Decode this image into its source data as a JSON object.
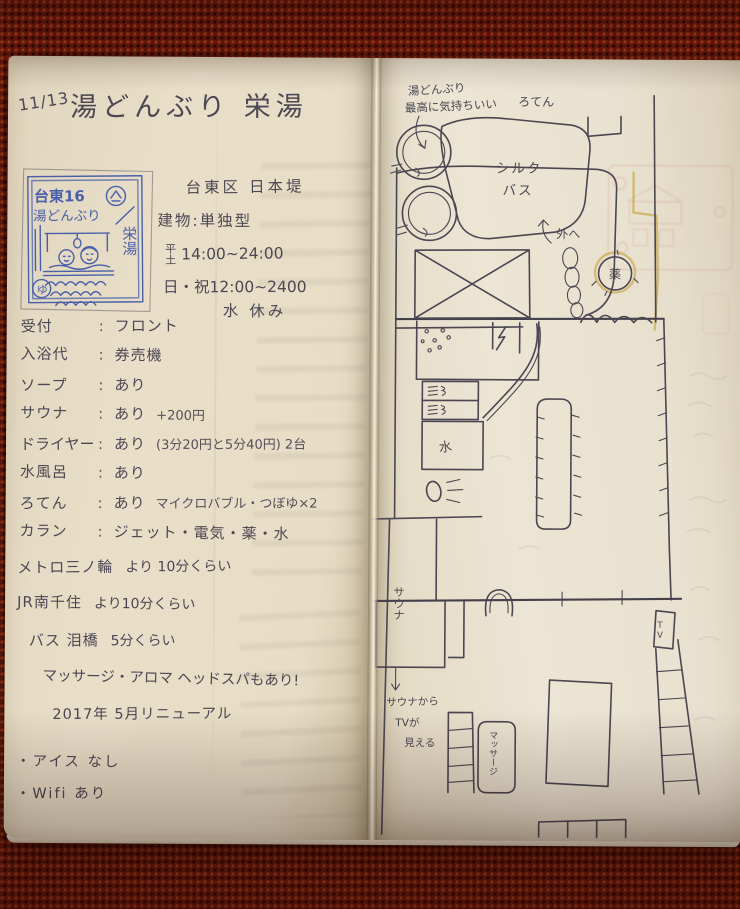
{
  "colors": {
    "fabric_red": "#701b0e",
    "paper_cream": "#e9e0cc",
    "ink_gray": "#4b4652",
    "stamp_blue": "#3c55a8",
    "bleed_yellow": "#c09a2e",
    "bleed_pink": "#d49a92"
  },
  "notebook": {
    "left_page": {
      "date": "11/13",
      "title": "湯どんぶり 栄湯",
      "stamp": {
        "row1": "台東16",
        "row2": "湯どんぶり",
        "name_vertical": "栄湯",
        "yu_mark": "ゆ"
      },
      "colon": ":",
      "info": {
        "area": "台東区 日本堤",
        "building_label": "建物",
        "building_value": "単独型",
        "hours1_day_top": "平",
        "hours1_day_bottom": "土",
        "hours1_time": "14:00~24:00",
        "hours2": "日・祝12:00~2400",
        "closed": "水 休み"
      },
      "details": [
        {
          "label": "受付",
          "value": "フロント",
          "extra": ""
        },
        {
          "label": "入浴代",
          "value": "券売機",
          "extra": ""
        },
        {
          "label": "ソープ",
          "value": "あり",
          "extra": ""
        },
        {
          "label": "サウナ",
          "value": "あり",
          "extra": "+200円"
        },
        {
          "label": "ドライヤー",
          "value": "あり",
          "extra": "(3分20円と5分40円) 2台"
        },
        {
          "label": "水風呂",
          "value": "あり",
          "extra": ""
        },
        {
          "label": "ろてん",
          "value": "あり",
          "extra": "マイクロバブル・つぼゆ×2"
        },
        {
          "label": "カラン",
          "value": "ジェット・電気・薬・水",
          "extra": ""
        }
      ],
      "access": [
        {
          "from": "メトロ三ノ輪",
          "time": "より 10分くらい"
        },
        {
          "from": "JR南千住",
          "time": "より10分くらい"
        },
        {
          "from": "バス 泪橋",
          "time": "5分くらい"
        }
      ],
      "notes": [
        "マッサージ・アロマ ヘッドスパもあり!",
        "2017年 5月リニューアル",
        "・アイス なし",
        "・Wifi あり"
      ]
    },
    "right_page": {
      "map": {
        "note1": "湯どんぶり",
        "note2": "最高に気持ちいい",
        "rotenburo": "ろてん",
        "silk1": "シルク",
        "silk2": "バス",
        "outside": "外へ",
        "medicine": "薬",
        "cold_water": "水",
        "sauna": "サウナ",
        "sauna_note1": "サウナから",
        "sauna_note2": "TVが",
        "sauna_note3": "見える",
        "tv": "TV",
        "massage": "マッサージ"
      }
    }
  }
}
